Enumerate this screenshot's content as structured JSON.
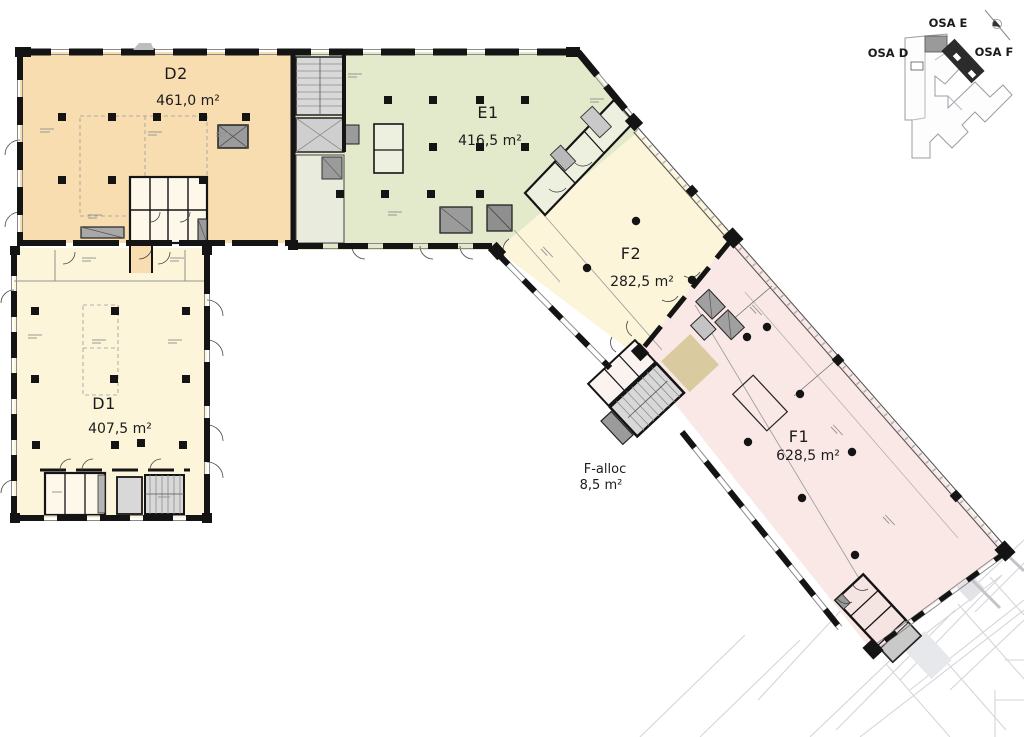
{
  "drawing": {
    "title": "Office floor plan with lettable area zones",
    "zones": [
      {
        "code": "D2",
        "area": "461,0 m²",
        "color": "#f8ddb1"
      },
      {
        "code": "E1",
        "area": "416,5 m²",
        "color": "#e3e9cb"
      },
      {
        "code": "F2",
        "area": "282,5 m²",
        "color": "#fcf5da"
      },
      {
        "code": "D1",
        "area": "407,5 m²",
        "color": "#fcf5da"
      },
      {
        "code": "F1",
        "area": "628,5 m²",
        "color": "#f9e8e6"
      }
    ],
    "allocation": {
      "label": "F-alloc",
      "area": "8,5 m²",
      "color": "#d9cb9f"
    },
    "key_plan": {
      "osa_d": "OSA D",
      "osa_e": "OSA E",
      "osa_f": "OSA F",
      "highlight_dark": "#2b2b2b",
      "highlight_gray": "#9a9a9a"
    },
    "wall_color": "#141414",
    "core_gray": "#d8d8d8",
    "shaft_gray": "#9b9b9b"
  }
}
